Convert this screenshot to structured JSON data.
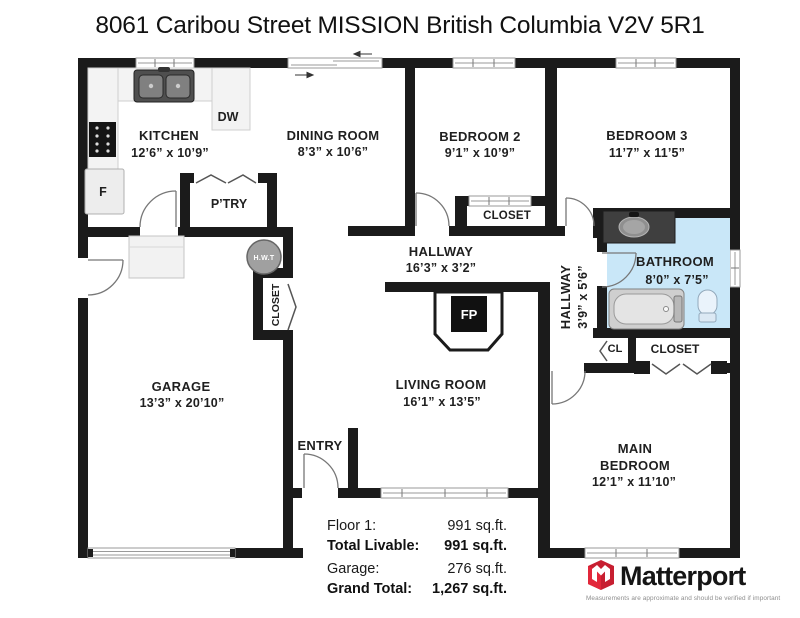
{
  "title": "8061 Caribou Street MISSION British Columbia V2V 5R1",
  "rooms": {
    "kitchen": {
      "name": "KITCHEN",
      "dims": "12’6” x 10’9”"
    },
    "dining_room": {
      "name": "DINING ROOM",
      "dims": "8’3” x 10’6”"
    },
    "bedroom2": {
      "name": "BEDROOM 2",
      "dims": "9’1” x 10’9”"
    },
    "bedroom3": {
      "name": "BEDROOM 3",
      "dims": "11’7” x 11’5”"
    },
    "hallway_main": {
      "name": "HALLWAY",
      "dims": "16’3” x 3’2”"
    },
    "hallway_small": {
      "name": "HALLWAY",
      "dims": "3’9” x 5’6”"
    },
    "bathroom": {
      "name": "BATHROOM",
      "dims": "8’0” x 7’5”"
    },
    "garage": {
      "name": "GARAGE",
      "dims": "13’3” x 20’10”"
    },
    "living_room": {
      "name": "LIVING ROOM",
      "dims": "16’1” x 13’5”"
    },
    "main_bedroom": {
      "name_line1": "MAIN",
      "name_line2": "BEDROOM",
      "dims": "12’1” x 11’10”"
    },
    "entry": {
      "name": "ENTRY"
    },
    "pantry": {
      "name": "P’TRY"
    }
  },
  "labels": {
    "closet_bedroom2": "CLOSET",
    "closet_garage": "CLOSET",
    "closet_main_bedroom": "CLOSET",
    "closet_small": "CL",
    "dishwasher": "DW",
    "fridge": "F",
    "hot_water_tank": "H.W.T",
    "fireplace": "FP"
  },
  "summary": {
    "rows": [
      {
        "label": "Floor 1:",
        "value": "991 sq.ft."
      },
      {
        "label": "Total Livable:",
        "value": "991 sq.ft."
      },
      {
        "label": "Garage:",
        "value": "276 sq.ft."
      },
      {
        "label": "Grand Total:",
        "value": "1,267 sq.ft."
      }
    ]
  },
  "branding": {
    "name": "Matterport",
    "tagline": "Measurements are approximate and should be verified if important",
    "brand_red": "#E2273A"
  },
  "colors": {
    "wall": "#1b1b1b",
    "bathroom_floor": "#c9e7f8"
  }
}
